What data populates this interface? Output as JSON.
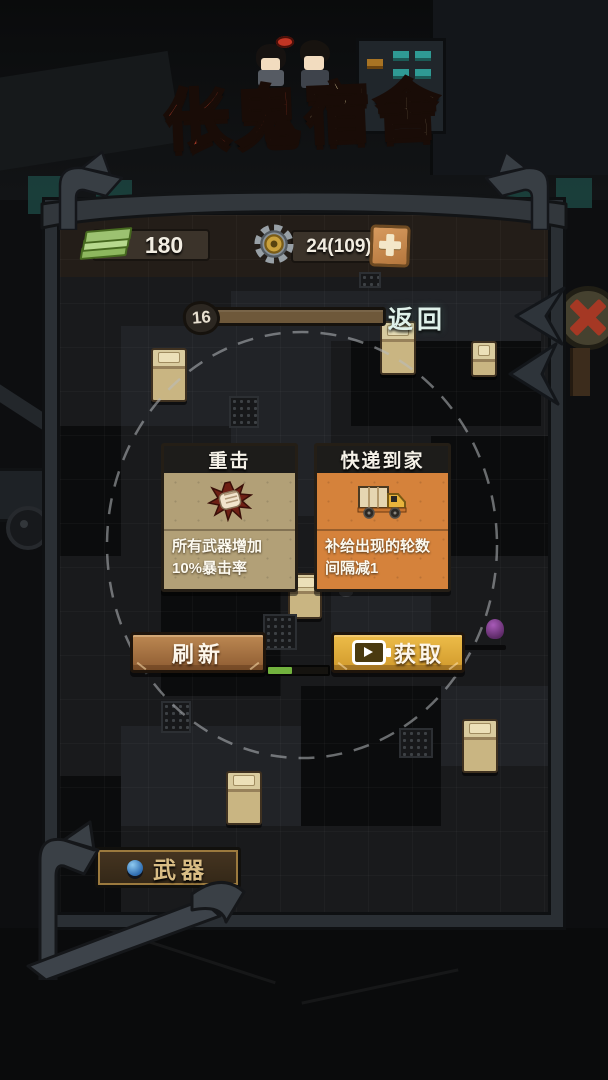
{
  "title": {
    "part_red": "伥鬼",
    "part_gold": "宿舍"
  },
  "hud": {
    "money": "180",
    "gears": "24(109)",
    "round": "16",
    "back_label": "返回"
  },
  "cards": [
    {
      "title": "重击",
      "desc": "所有武器增加10%暴击率",
      "icon": "fist-icon",
      "body_color": "#b2a077"
    },
    {
      "title": "快递到家",
      "desc": "补给出现的轮数间隔减1",
      "icon": "truck-icon",
      "body_color": "#d5823b"
    }
  ],
  "actions": {
    "refresh_label": "刷新",
    "claim_label": "获取",
    "claim_icon": "video-icon",
    "refresh_progress_percent": 40
  },
  "footer": {
    "weapons_label": "武器",
    "weapons_icon": "weapon-icon"
  },
  "icons": {
    "money": "money-icon",
    "gear": "gear-icon",
    "plus": "plus-icon",
    "video": "video-icon",
    "fist": "fist-icon",
    "truck": "truck-icon",
    "weapon": "weapon-icon"
  },
  "colors": {
    "title_red": "#c9432e",
    "title_gold": "#ead9a6",
    "card_tan": "#b2a077",
    "card_orange": "#d5823b",
    "refresh_brown": "#bc8852",
    "claim_gold": "#edbc49",
    "progress_green": "#72b23e",
    "money_green": "#9cc271",
    "round_bar_brown": "#6e583a"
  }
}
